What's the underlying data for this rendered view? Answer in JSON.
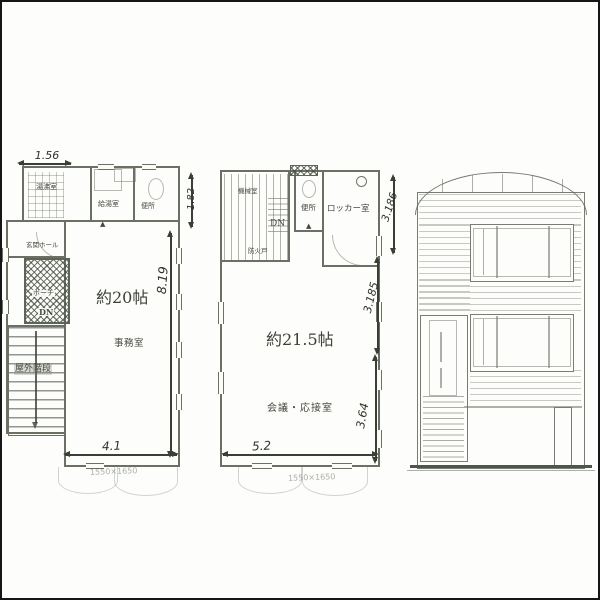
{
  "icons": {
    "fire_door_marker": "▲"
  },
  "plan1": {
    "labels": {
      "room_top_left": "湯沸室",
      "room_top_mid": "給湯室",
      "room_top_right": "便所",
      "entrance_hall": "玄関ホール",
      "porch": "ポーチ",
      "down": "DN",
      "area": "約20帖",
      "room_main": "事務室",
      "outdoor_stairs": "屋外階段"
    },
    "dimensions": {
      "top_width": "1.56",
      "upper_right_height": "1.82",
      "right_height": "8.19",
      "bottom_width": "4.1",
      "module_note": "1550×1650"
    }
  },
  "plan2": {
    "labels": {
      "machine_room": "機械室",
      "fire_door": "防火戸",
      "down": "DN",
      "toilet": "便所",
      "locker_room": "ロッカー室",
      "area": "約21.5帖",
      "room_main": "会議・応接室"
    },
    "dimensions": {
      "right_upper": "3.186",
      "right_middle": "3.185",
      "right_lower": "3.64",
      "bottom_width": "5.2",
      "module_note": "1550×1650"
    }
  }
}
